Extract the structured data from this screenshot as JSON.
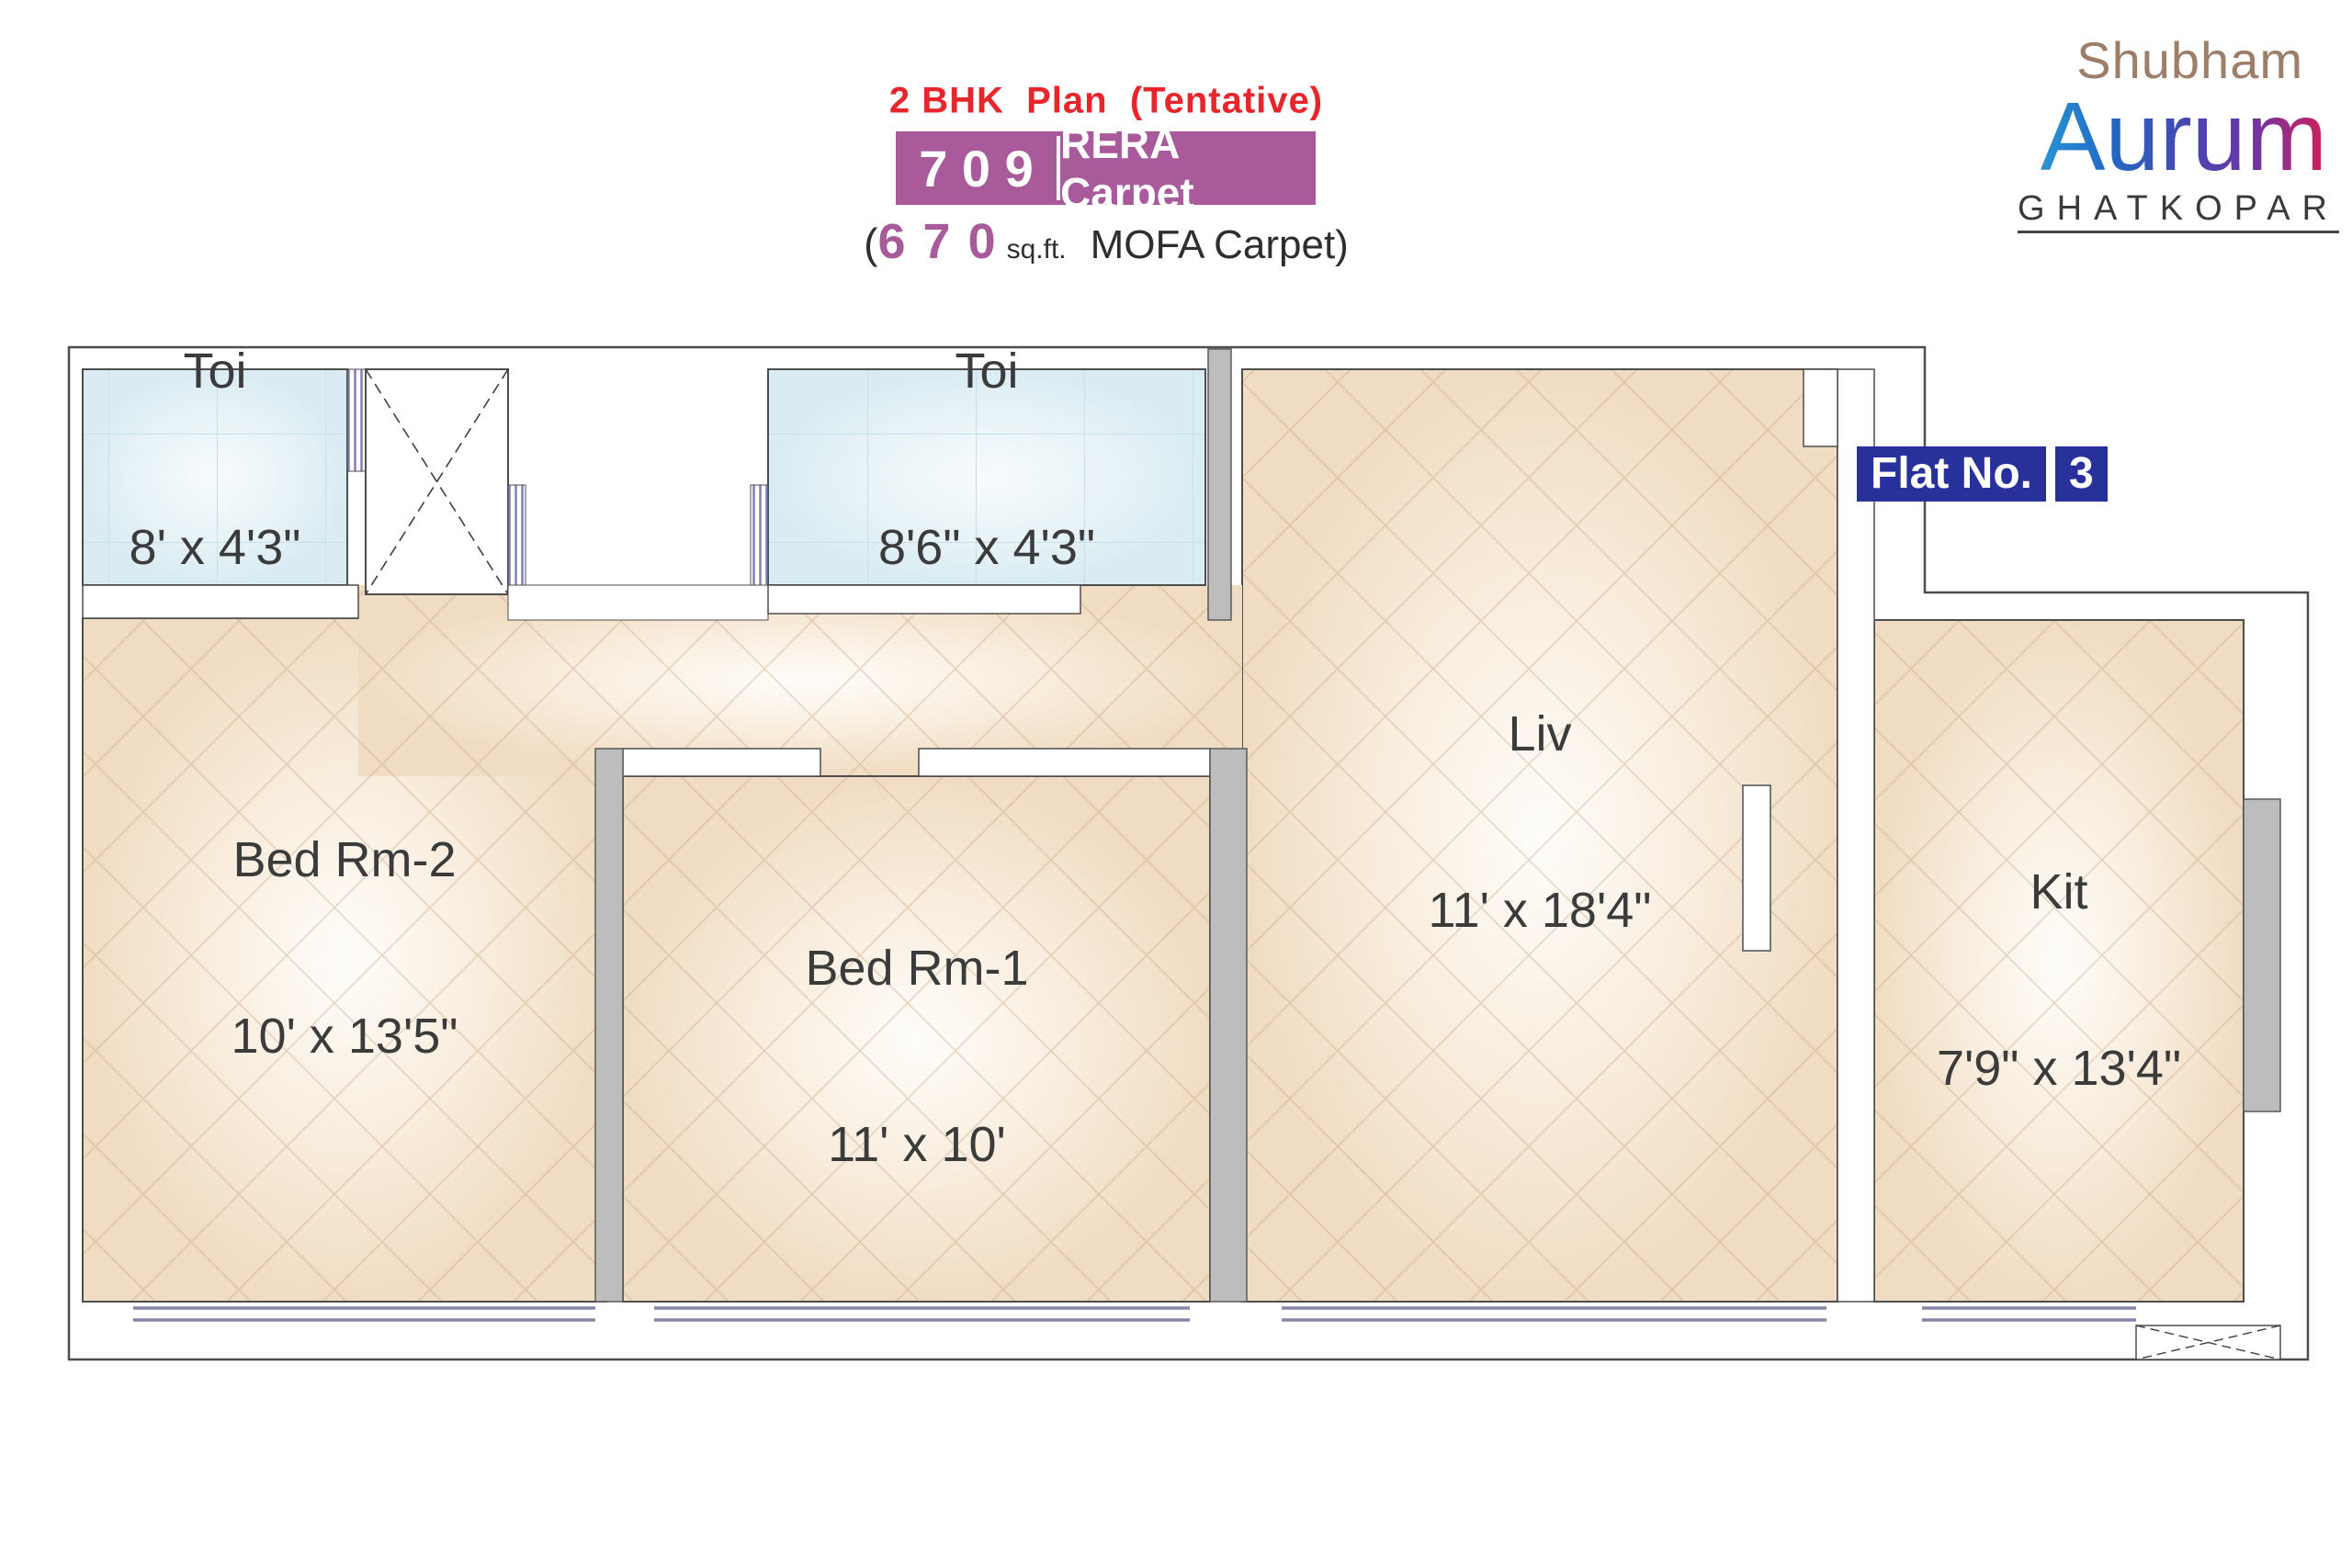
{
  "header": {
    "title": "2 BHK  Plan  (Tentative)",
    "rera": {
      "value": "7 0 9",
      "label": "RERA Carpet"
    },
    "mofa": {
      "prefix": "(",
      "value": "6 7 0",
      "unit": "sq.ft.",
      "suffix": "MOFA Carpet)"
    }
  },
  "logo": {
    "brand": "Shubham",
    "project": "Aurum",
    "location": "GHATKOPAR"
  },
  "flat_badge": {
    "label": "Flat No.",
    "number": "3"
  },
  "rooms": [
    {
      "id": "toilet-1",
      "name": "Toi",
      "dims": "8' x 4'3\""
    },
    {
      "id": "toilet-2",
      "name": "Toi",
      "dims": "8'6\" x 4'3\""
    },
    {
      "id": "bedroom-2",
      "name": "Bed Rm-2",
      "dims": "10' x 13'5\""
    },
    {
      "id": "bedroom-1",
      "name": "Bed Rm-1",
      "dims": "11' x 10'"
    },
    {
      "id": "living",
      "name": "Liv",
      "dims": "11' x 18'4\""
    },
    {
      "id": "kitchen",
      "name": "Kit",
      "dims": "7'9\" x 13'4\""
    }
  ],
  "colors": {
    "title_red": "#e8252b",
    "purple": "#a85a9a",
    "badge_blue": "#28309b",
    "logo_brand_tan": "#9c7e69",
    "logo_location_gray": "#3a3a3a",
    "floor_beige": "#f0dcc2",
    "floor_tile_blue": "#d9ecf3",
    "wall_gray": "#bdbdbd",
    "outline_gray": "#4d4d4d",
    "window_line": "#8585a6"
  }
}
